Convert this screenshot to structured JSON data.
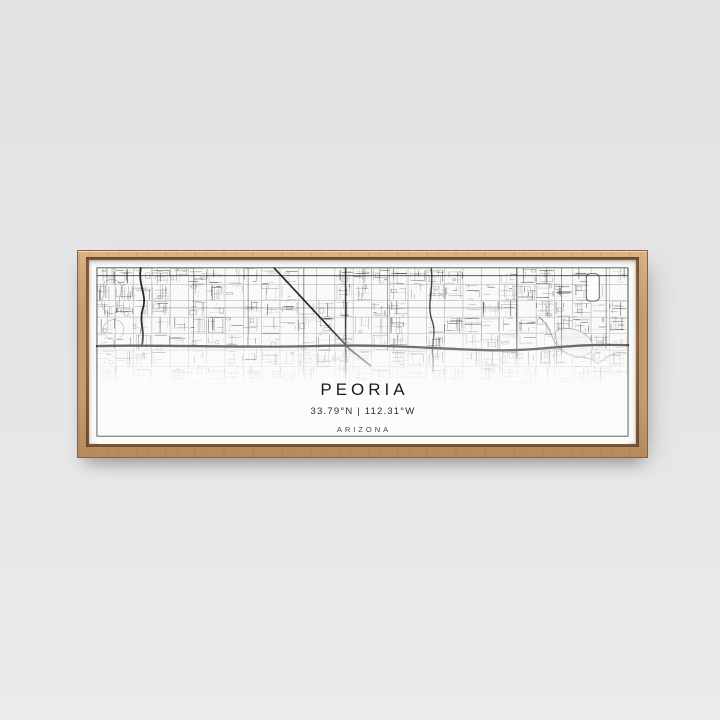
{
  "scene": {
    "wall_top_color": "#e2e2e4",
    "wall_bottom_color": "#ebebed"
  },
  "frame": {
    "wood_color": "#c69d6f",
    "wood_light_color": "#d8b487",
    "wood_dark_color": "#b68a5c",
    "lip_color": "#8a6040"
  },
  "poster": {
    "title": "PEORIA",
    "coordinates": "33.79°N | 112.31°W",
    "region": "ARIZONA",
    "paper_color": "#fcfcfb",
    "ink_color": "#111111",
    "street_color": "#3a3a3a",
    "grid_color": "#9b9b9b",
    "water_color": "#8a8a8a",
    "border_color": "#3c3c3c"
  }
}
